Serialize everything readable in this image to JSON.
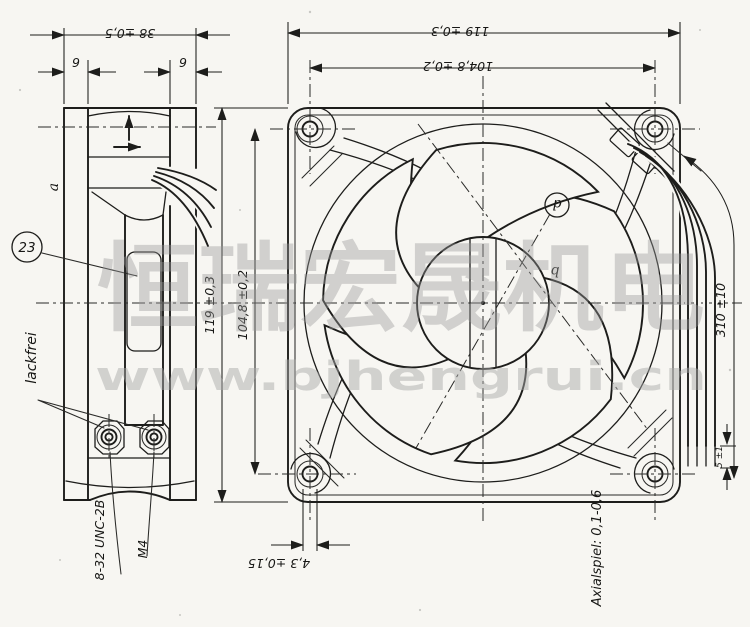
{
  "watermark": {
    "brand": "恒瑞宏晟机电",
    "url": "www.bjhengrui.cn"
  },
  "side_view": {
    "dim_depth": "38 ±0,5",
    "dim_flange_left": "9",
    "dim_flange_right": "9",
    "ref_a": "a",
    "balloon": "23",
    "note_unpainted": "lackfrei",
    "thread_unc": "8-32 UNC-2B",
    "thread_m4": "M4"
  },
  "front_view": {
    "dim_width": "119 ±0,3",
    "dim_hole_pitch_top": "104,8 ±0,2",
    "dim_height": "119 ±0,3",
    "dim_hole_pitch_left": "104,8 ±0,2",
    "dim_hole_dia": "4,3 ±0,15",
    "dim_lead_length": "310 ±10",
    "dim_strip_length": "5 ±1",
    "ref_b": "b",
    "ref_d": "d",
    "note_axial_play": "Axialspiel: 0,1-0,6"
  }
}
